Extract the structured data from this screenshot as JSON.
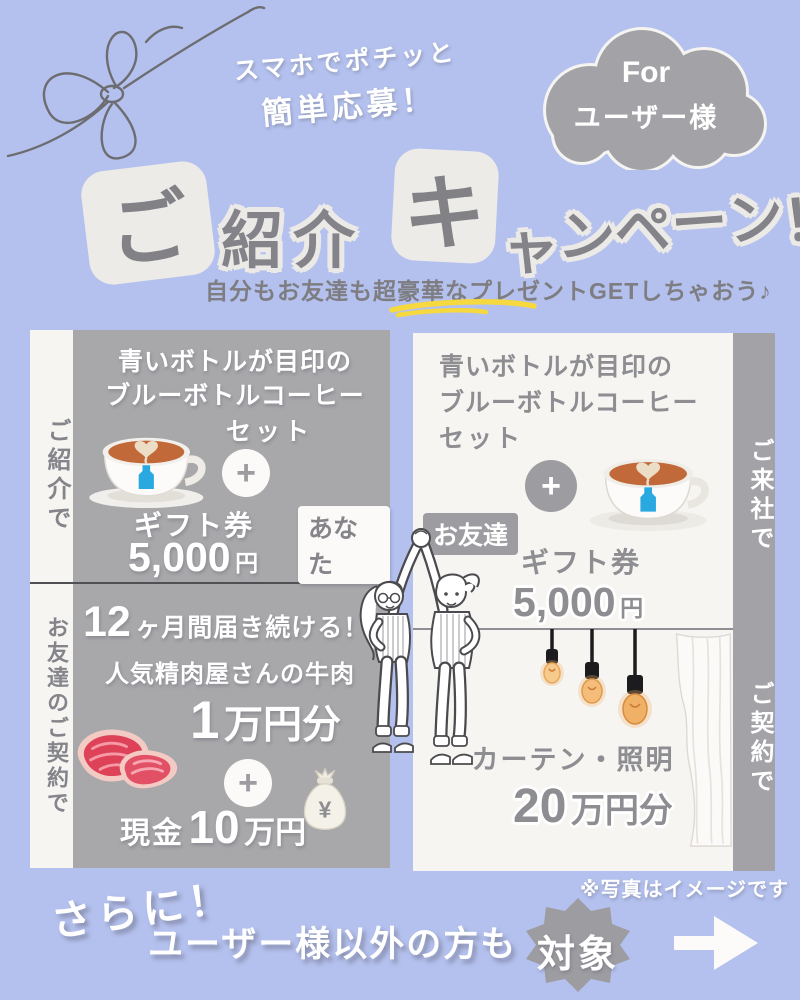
{
  "colors": {
    "background": "#b4c1ee",
    "panel_gray": "#a8a8ab",
    "panel_white": "#f6f5f2",
    "cloud_gray": "#a3a3a7",
    "badge_gray": "#9c9ca1",
    "text_gray": "#838389",
    "accent_yellow": "#f6d83f",
    "blue_bottle_logo": "#2aa9e1",
    "meat_red": "#dd4258",
    "bulb_amber": "#f6c98d"
  },
  "header": {
    "tagline_line1": "スマホでポチッと",
    "tagline_line2": "簡単応募！",
    "cloud_line1": "For",
    "cloud_line2": "ユーザー様",
    "title_tile1": "ご",
    "title_part1": "紹介",
    "title_tile2": "キ",
    "title_part2_chars": [
      "ャ",
      "ン",
      "ペ",
      "ー",
      "ン",
      "！"
    ],
    "subtitle": "自分もお友達も超豪華なプレゼントGETしちゃおう♪"
  },
  "referral_panel": {
    "side_label": "ご紹介で",
    "prize1_line1": "青いボトルが目印の",
    "prize1_line2": "ブルーボトルコーヒー",
    "prize1_line3": "セット",
    "plus": "+",
    "prize2_label": "ギフト券",
    "prize2_amount": "5,000",
    "prize2_unit": "円",
    "badge": "あなた"
  },
  "friend_panel": {
    "side_label": "お友達のご契約で",
    "prize1_num": "12",
    "prize1_rest": "ヶ月間届き続ける！",
    "prize1_line2": "人気精肉屋さんの牛肉",
    "prize1_amount": "1",
    "prize1_amount_unit": "万円分",
    "plus": "+",
    "moneybag_symbol": "¥",
    "prize2_label": "現金",
    "prize2_amount": "10",
    "prize2_unit": "万円"
  },
  "visit_panel": {
    "side_label": "ご来社で",
    "prize1_line1": "青いボトルが目印の",
    "prize1_line2": "ブルーボトルコーヒー",
    "prize1_line3": "セット",
    "plus": "+",
    "badge": "お友達",
    "prize2_label": "ギフト券",
    "prize2_amount": "5,000",
    "prize2_unit": "円"
  },
  "contract_panel": {
    "side_label": "ご契約で",
    "prize_label": "カーテン・照明",
    "prize_amount": "20",
    "prize_unit": "万円分"
  },
  "footer": {
    "photo_note": "※写真はイメージです",
    "more_label": "さらに！",
    "audience_label": "ユーザー様以外の方も",
    "target_badge": "対象"
  }
}
